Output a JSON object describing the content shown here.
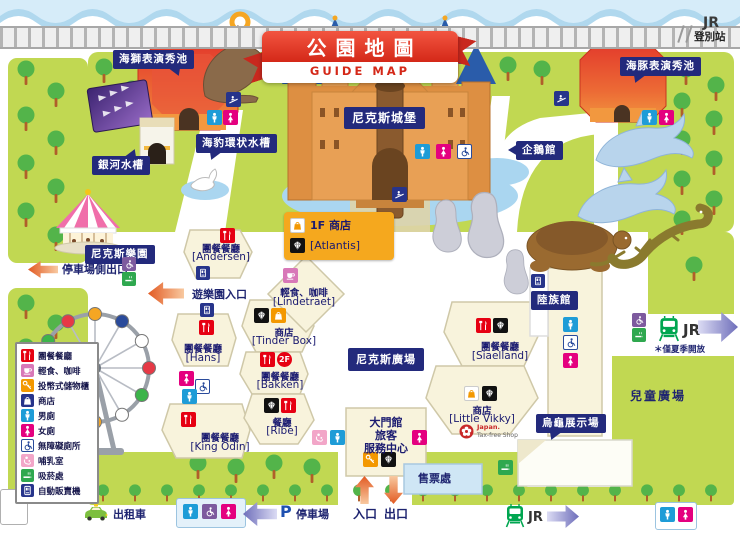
{
  "title": {
    "main": "公園地圖",
    "sub": "GUIDE MAP"
  },
  "station": {
    "jr": "JR",
    "name": "登別站"
  },
  "areas": {
    "sea_lion_pool": "海獅表演秀池",
    "galaxy_tank": "銀河水槽",
    "seal_ring_tank": "海豹環状水槽",
    "castle": "尼克斯城堡",
    "penguin_house": "企鵝館",
    "dolphin_pool": "海豚表演秀池",
    "nixe_land": "尼克斯樂園",
    "nixe_square": "尼克斯廣場",
    "land_animal_house": "陸族館",
    "turtle_exhibit": "烏龜展示場",
    "children_plaza": "兒童廣場"
  },
  "facilities": {
    "andersen": {
      "type": "團餐餐廳",
      "name": "[Andersen]"
    },
    "hans": {
      "type": "團餐餐廳",
      "name": "[Hans]"
    },
    "king_odin": {
      "type": "團餐餐廳",
      "name": "[King Odin]"
    },
    "bakken": {
      "type": "團餐餐廳",
      "name": "[Bakken]",
      "floor": "2F"
    },
    "ribe": {
      "type": "餐廳",
      "name": "[Ribe]"
    },
    "siaelland": {
      "type": "團餐餐廳",
      "name": "[Siaelland]"
    },
    "lindetraet": {
      "type": "輕食、咖啡",
      "name": "[Lindetraet]"
    },
    "tinder_box": {
      "type": "商店",
      "name": "[Tinder Box]"
    },
    "little_vikky": {
      "type": "商店",
      "name": "[Little Vikky]",
      "taxfree_line1": "Japan.",
      "taxfree_line2": "Tax-free Shop"
    },
    "atlantis": {
      "type": "1F 商店",
      "name": "[Atlantis]"
    },
    "main_gate": {
      "line1": "大門館",
      "line2": "旅客",
      "line3": "服務中心"
    }
  },
  "navigation": {
    "parking_side_exit": "停車場側出口",
    "park_entrance": "遊樂園入口",
    "entrance": "入口",
    "exit": "出口",
    "ticket_office": "售票處",
    "taxi": "出租車",
    "parking_p": "P",
    "parking_lot": "停車場",
    "jr": "JR",
    "summer_only": "＊僅夏季開放"
  },
  "legend": {
    "items": [
      {
        "icon": "restaurant-icon",
        "label": "團餐餐廳"
      },
      {
        "icon": "cafe-icon",
        "label": "輕食、咖啡"
      },
      {
        "icon": "locker-icon",
        "label": "投幣式儲物櫃"
      },
      {
        "icon": "shop-icon",
        "label": "商店"
      },
      {
        "icon": "mens-toilet-icon",
        "label": "男廁"
      },
      {
        "icon": "womens-toilet-icon",
        "label": "女廁"
      },
      {
        "icon": "accessible-toilet-icon",
        "label": "無障礙廁所"
      },
      {
        "icon": "nursing-room-icon",
        "label": "哺乳室"
      },
      {
        "icon": "smoking-area-icon",
        "label": "吸菸處"
      },
      {
        "icon": "vending-machine-icon",
        "label": "自動販賣機"
      }
    ]
  },
  "colors": {
    "park_green": "#c1d852",
    "tree_green": "#53b44a",
    "label_navy": "#232a7c",
    "building_red": "#e33b2c",
    "building_orange_rim": "#f2983f",
    "castle_orange": "#e8a055",
    "roof_blue": "#2a5caa",
    "pond_blue": "#aad6f0",
    "restaurant_red": "#e60012",
    "cafe_pink": "#d878b8",
    "locker_orange": "#f39800",
    "male_blue": "#1e9cd7",
    "female_pink": "#e4007f",
    "smoking_green": "#2fa84f",
    "vending_navy": "#27348b",
    "arrow_orange": "#e25a22",
    "arrow_purple": "#6e6eba",
    "jr_green": "#00a650",
    "ribbon_red": "#d42818"
  }
}
